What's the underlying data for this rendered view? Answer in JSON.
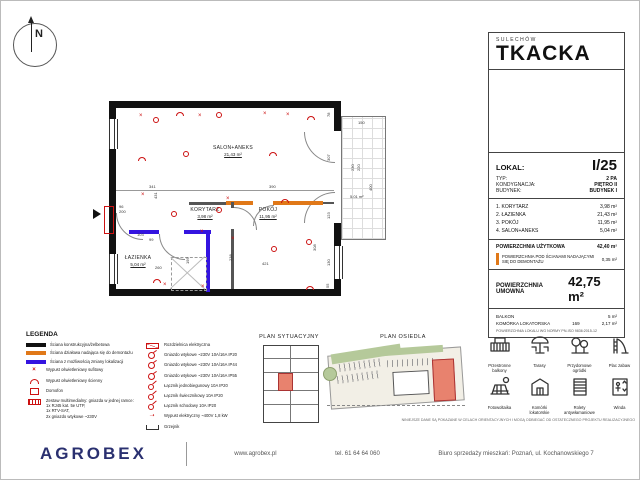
{
  "colors": {
    "wall_black": "#111111",
    "wall_demountable_orange": "#e07818",
    "wall_movable_blue": "#3414e0",
    "electric_red": "#cc1111",
    "brand_navy": "#2a3070"
  },
  "compass": {
    "label": "N"
  },
  "header": {
    "city": "SULECHÓW",
    "project": "TKACKA"
  },
  "card": {
    "lokal_label": "LOKAL:",
    "lokal_value": "I/25",
    "typ_label": "TYP:",
    "typ_value": "2 PA",
    "kondygnacja_label": "KONDYGNACJA:",
    "kondygnacja_value": "PIĘTRO II",
    "budynek_label": "BUDYNEK:",
    "budynek_value": "BUDYNEK I",
    "rooms": [
      {
        "name": "1. KORYTARZ",
        "area": "3,98 m²"
      },
      {
        "name": "2. ŁAZIENKA",
        "area": "21,43 m²"
      },
      {
        "name": "3. POKÓJ",
        "area": "11,95 m²"
      },
      {
        "name": "4. SALON+ANEKS",
        "area": "5,04 m²"
      }
    ],
    "uzytkowa_label": "POWIERZCHNIA UŻYTKOWA",
    "uzytkowa_value": "42,40 m²",
    "sciany_label": "POWIERZCHNIA POD ŚCIANAMI NADAJĄCYMI SIĘ DO DEMONTAŻU",
    "sciany_value": "0,35 m²",
    "umowna_label": "POWIERZCHNIA UMOWNA",
    "umowna_value": "42,75 m²",
    "balkon_label": "BALKON",
    "balkon_value": "5 m²",
    "komorka_label": "KOMÓRKA LOKATORSKA",
    "komorka_no": "169",
    "komorka_value": "2,17 m²",
    "norm_note": "POWIERZCHNIA LOKALU WG NORMY PN-ISO 9836:2015-12"
  },
  "floor_plan": {
    "rooms": [
      {
        "name": "SALON+ANEKS",
        "area": "21,43 m²",
        "x": 232,
        "y": 144
      },
      {
        "name": "KORYTARZ",
        "area": "3,98 m²",
        "x": 204,
        "y": 206
      },
      {
        "name": "POKÓJ",
        "area": "11,95 m²",
        "x": 267,
        "y": 206
      },
      {
        "name": "ŁAZIENKA",
        "area": "5,04 m²",
        "x": 137,
        "y": 254
      }
    ],
    "balcony_area": "5,01 m²",
    "dimensions": [
      {
        "t": "341",
        "x": 148,
        "y": 183
      },
      {
        "t": "390",
        "x": 268,
        "y": 183
      },
      {
        "t": "431",
        "x": 152,
        "y": 198,
        "v": true
      },
      {
        "t": "307",
        "x": 325,
        "y": 160,
        "v": true
      },
      {
        "t": "78",
        "x": 325,
        "y": 116,
        "v": true
      },
      {
        "t": "123",
        "x": 325,
        "y": 218,
        "v": true
      },
      {
        "t": "308",
        "x": 311,
        "y": 250,
        "v": true
      },
      {
        "t": "130",
        "x": 325,
        "y": 265,
        "v": true
      },
      {
        "t": "55",
        "x": 324,
        "y": 287,
        "v": true
      },
      {
        "t": "96",
        "x": 118,
        "y": 203
      },
      {
        "t": "200",
        "x": 118,
        "y": 208
      },
      {
        "t": "103",
        "x": 136,
        "y": 231
      },
      {
        "t": "99",
        "x": 148,
        "y": 236
      },
      {
        "t": "260",
        "x": 154,
        "y": 264
      },
      {
        "t": "195",
        "x": 184,
        "y": 263,
        "v": true
      },
      {
        "t": "238",
        "x": 227,
        "y": 260,
        "v": true
      },
      {
        "t": "421",
        "x": 261,
        "y": 260
      },
      {
        "t": "150",
        "x": 357,
        "y": 119
      },
      {
        "t": "230",
        "x": 349,
        "y": 170,
        "v": true
      },
      {
        "t": "220",
        "x": 355,
        "y": 170,
        "v": true
      },
      {
        "t": "400",
        "x": 367,
        "y": 190,
        "v": true
      }
    ],
    "symbols": [
      {
        "t": "x",
        "x": 138,
        "y": 112
      },
      {
        "t": "o",
        "x": 152,
        "y": 116
      },
      {
        "t": "arc",
        "x": 175,
        "y": 111
      },
      {
        "t": "x",
        "x": 197,
        "y": 112
      },
      {
        "t": "o",
        "x": 215,
        "y": 111
      },
      {
        "t": "x",
        "x": 262,
        "y": 110
      },
      {
        "t": "x",
        "x": 285,
        "y": 111
      },
      {
        "t": "arc",
        "x": 306,
        "y": 115
      },
      {
        "t": "arc",
        "x": 137,
        "y": 156
      },
      {
        "t": "o",
        "x": 182,
        "y": 150
      },
      {
        "t": "arc",
        "x": 268,
        "y": 151
      },
      {
        "t": "x",
        "x": 225,
        "y": 195
      },
      {
        "t": "x",
        "x": 140,
        "y": 191
      },
      {
        "t": "o",
        "x": 215,
        "y": 206
      },
      {
        "t": "arc",
        "x": 280,
        "y": 198
      },
      {
        "t": "o",
        "x": 170,
        "y": 210
      },
      {
        "t": "x",
        "x": 199,
        "y": 228
      },
      {
        "t": "x",
        "x": 230,
        "y": 235
      },
      {
        "t": "o",
        "x": 270,
        "y": 245
      },
      {
        "t": "o",
        "x": 305,
        "y": 238
      },
      {
        "t": "arc",
        "x": 152,
        "y": 278
      },
      {
        "t": "x",
        "x": 162,
        "y": 281
      },
      {
        "t": "x",
        "x": 200,
        "y": 283
      },
      {
        "t": "arc",
        "x": 305,
        "y": 285
      }
    ]
  },
  "legend": {
    "title": "LEGENDA",
    "left": [
      {
        "icon": "sw-black",
        "text": "Ściana konstrukcyjna/żelbetowa"
      },
      {
        "icon": "sw-orange",
        "text": "Ściana działowa nadająca się do demontażu"
      },
      {
        "icon": "sw-blue",
        "text": "Ściana z możliwością zmiany lokalizacji"
      },
      {
        "icon": "lg-x",
        "text": "Wypust oświetleniowy sufitowy"
      },
      {
        "icon": "lg-arc",
        "text": "Wypust oświetleniowy ścienny"
      },
      {
        "icon": "lg-dom",
        "text": "Domofon"
      },
      {
        "icon": "lg-multi",
        "text": "Zestaw multimedialny: gniazda w jednej ramce:\n1x RJ45 kat. 5e UTP,\n1x RTV-SAT,\n2x gniazdo wtykowe ~230V"
      }
    ],
    "right": [
      {
        "icon": "lg-rozdz",
        "text": "Rozdzielnica elektryczna"
      },
      {
        "icon": "lg-gn",
        "text": "Gniazdo wtykowe ~230V 10A/16A IP20"
      },
      {
        "icon": "lg-gn",
        "text": "Gniazdo wtykowe ~230V 10A/16A IP44"
      },
      {
        "icon": "lg-gn",
        "text": "Gniazdo wtykowe ~230V 10A/16A IP55"
      },
      {
        "icon": "lg-lacz",
        "text": "Łącznik jednobiegunowy 10A IP20"
      },
      {
        "icon": "lg-lacz",
        "text": "Łącznik świecznikowy 10A IP20"
      },
      {
        "icon": "lg-lacz",
        "text": "Łącznik schodowy 10A IP20"
      },
      {
        "icon": "lg-wyp",
        "text": "Wypust elektryczny ~400V 1,8 kW"
      },
      {
        "icon": "lg-grz",
        "text": "Grzejnik"
      }
    ]
  },
  "plans": {
    "sytuacyjny": "PLAN SYTUACYJNY",
    "osiedla": "PLAN OSIEDLA"
  },
  "amenities": [
    {
      "icon": "balcony-icon",
      "label": "Przestronne\nbalkony"
    },
    {
      "icon": "terrace-icon",
      "label": "Tarasy"
    },
    {
      "icon": "garden-icon",
      "label": "Przydomowe\nogródki"
    },
    {
      "icon": "playground-icon",
      "label": "Plac zabaw"
    },
    {
      "icon": "solar-icon",
      "label": "Fotowoltaika"
    },
    {
      "icon": "storage-icon",
      "label": "Komórki\nlokatorskie"
    },
    {
      "icon": "blinds-icon",
      "label": "Rolety\nantywłamaniowe"
    },
    {
      "icon": "elevator-icon",
      "label": "Winda"
    }
  ],
  "disclaimer": "NINIEJSZE DANE SĄ POKAZANE W CELACH ORIENTACYJNYCH I MOGĄ ODBIEGAĆ OD OSTATECZNEGO PROJEKTU REALIZACYJNEGO",
  "footer": {
    "logo": "AGROBEX",
    "www": "www.agrobex.pl",
    "tel": "tel. 61 64 64 060",
    "office": "Biuro sprzedaży mieszkań: Poznań, ul. Kochanowskiego 7"
  }
}
